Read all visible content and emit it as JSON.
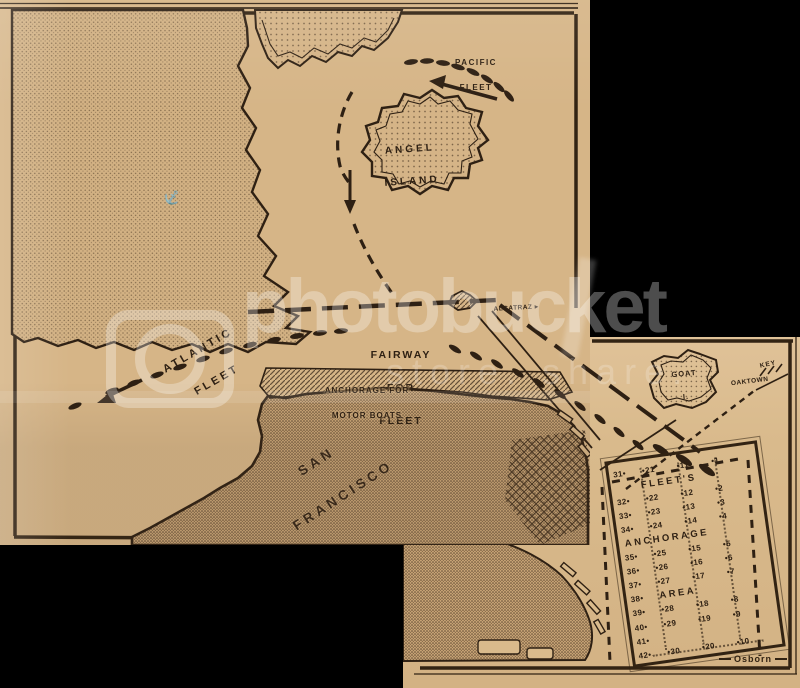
{
  "watermark": {
    "brand": "photobucket",
    "tagline": "store. share.",
    "logo_icon": "camera-lens-icon"
  },
  "map": {
    "labels": {
      "pacific_fleet": [
        "PACIFIC",
        "FLEET"
      ],
      "angel_island": [
        "ANGEL",
        "ISLAND"
      ],
      "atlantic_fleet": [
        "ATLANTIC",
        "FLEET"
      ],
      "fairway": [
        "FAIRWAY",
        "FOR",
        "FLEET"
      ],
      "motorboat_anchorage": [
        "ANCHORAGE FOR",
        "MOTOR BOATS"
      ],
      "alcatraz": "ALCATRAZ",
      "alcatraz_pointer": "▸",
      "san_francisco": [
        "SAN",
        "FRANCISCO"
      ],
      "goat_island": [
        "GOAT",
        "I."
      ],
      "key": "KEY",
      "oaktown": "OAKTOWN",
      "signature": "Osborn"
    },
    "anchorage_grid": {
      "title_words": [
        "FLEET'S",
        "ANCHORAGE",
        "AREA"
      ],
      "rows": [
        {
          "left": "31",
          "cells": [
            "21",
            "11",
            "1"
          ]
        },
        {
          "word": "FLEET'S",
          "indent": 26
        },
        {
          "left": "32",
          "cells": [
            "22",
            "12",
            "2"
          ]
        },
        {
          "left": "33",
          "cells": [
            "23",
            "13",
            "3"
          ]
        },
        {
          "left": "34",
          "cells": [
            "24",
            "14",
            "4"
          ]
        },
        {
          "word": "ANCHORAGE",
          "indent": 2
        },
        {
          "left": "35",
          "cells": [
            "25",
            "15",
            "5"
          ]
        },
        {
          "left": "36",
          "cells": [
            "26",
            "16",
            "6"
          ]
        },
        {
          "left": "37",
          "cells": [
            "27",
            "17",
            "7"
          ]
        },
        {
          "left": "38",
          "word": "AREA"
        },
        {
          "left": "39",
          "cells": [
            "28",
            "18",
            "8"
          ]
        },
        {
          "left": "40",
          "cells": [
            "29",
            "19",
            "9"
          ]
        },
        {
          "left": "41",
          "cells": []
        },
        {
          "left": "42",
          "cells": [
            "30",
            "20",
            "10"
          ]
        }
      ]
    },
    "colors": {
      "paper": "#d6b587",
      "paper_light": "#e0c298",
      "ink": "#2e2013",
      "background": "#000000",
      "watermark": "#ffffff"
    }
  }
}
